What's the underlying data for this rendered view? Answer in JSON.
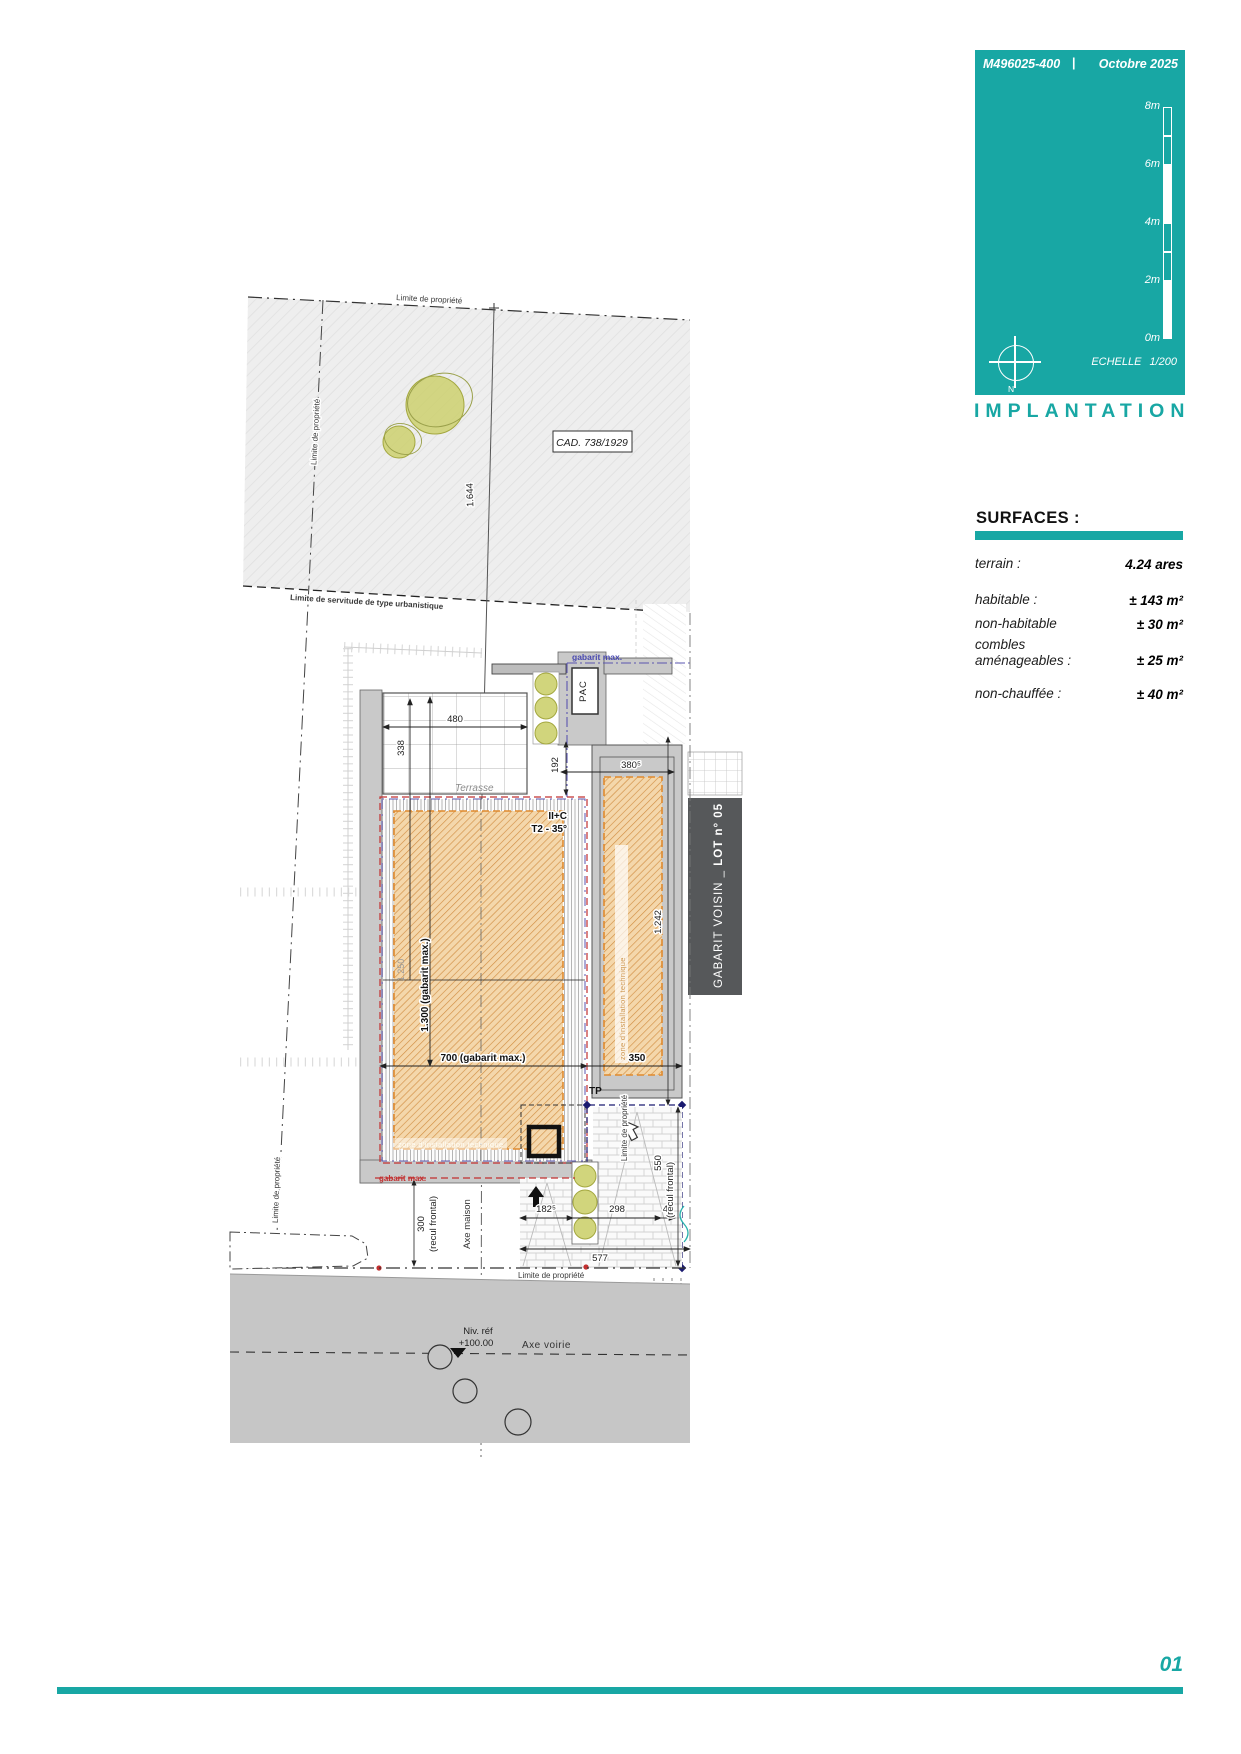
{
  "header": {
    "ref": "M496025-400",
    "sep": "|",
    "date": "Octobre 2025",
    "scale_ticks": [
      "8m",
      "6m",
      "4m",
      "2m",
      "0m"
    ],
    "north_label": "N",
    "echelle_label": "ECHELLE",
    "echelle_value": "1/200",
    "title": "IMPLANTATION"
  },
  "surfaces": {
    "heading": "SURFACES :",
    "rows": [
      {
        "label": "terrain :",
        "value": "4.24 ares"
      },
      {
        "label": "habitable :",
        "value": "± 143 m²"
      },
      {
        "label": "non-habitable",
        "value": "± 30 m²"
      },
      {
        "label": "combles\naménageables :",
        "value": "± 25 m²"
      },
      {
        "label": "non-chauffée :",
        "value": "± 40 m²"
      }
    ]
  },
  "plan": {
    "limite_propriete": "Limite de propriété",
    "servitude": "Limite de servitude de type urbanistique",
    "cad_ref": "CAD. 738/1929",
    "dim_1644": "1.644",
    "terrasse": "Terrasse",
    "dim_480": "480",
    "dim_338": "338",
    "dim_192": "192",
    "dim_380_5": "380⁵",
    "pac": "PAC",
    "gabarit_max": "gabarit max.",
    "niveaux": "II+C",
    "toiture": "T2 - 35°",
    "dim_1250": "1.250",
    "dim_1300": "1.300 (gabarit max.)",
    "dim_700": "700 (gabarit max.)",
    "dim_1242": "1.242",
    "dim_350": "350",
    "tp": "TP",
    "zone_technique": "zone d'installation technique",
    "gabarit_voisin": "GABARIT VOISIN _ ",
    "lot": "LOT n° 05",
    "recul_300": "300",
    "recul_550": "550",
    "recul_frontal": "(recul frontal)",
    "axe_maison": "Axe maison",
    "dim_182_5": "182⁵",
    "dim_298": "298",
    "dim_48": "48",
    "dim_577": "577",
    "niv_ref_line1": "Niv. réf",
    "niv_ref_line2": "+100.00",
    "axe_voirie": "Axe voirie"
  },
  "footer": {
    "page": "01"
  },
  "colors": {
    "teal": "#18a7a4",
    "orange_hatch": "#d28f44",
    "red_gabarit": "#c23030",
    "violet_gabarit": "#5a55b0",
    "navy_gabarit": "#1a1a70",
    "olive_tree": "#ccd06e",
    "dark_box": "#56585a",
    "road_gray": "#c6c6c6"
  }
}
